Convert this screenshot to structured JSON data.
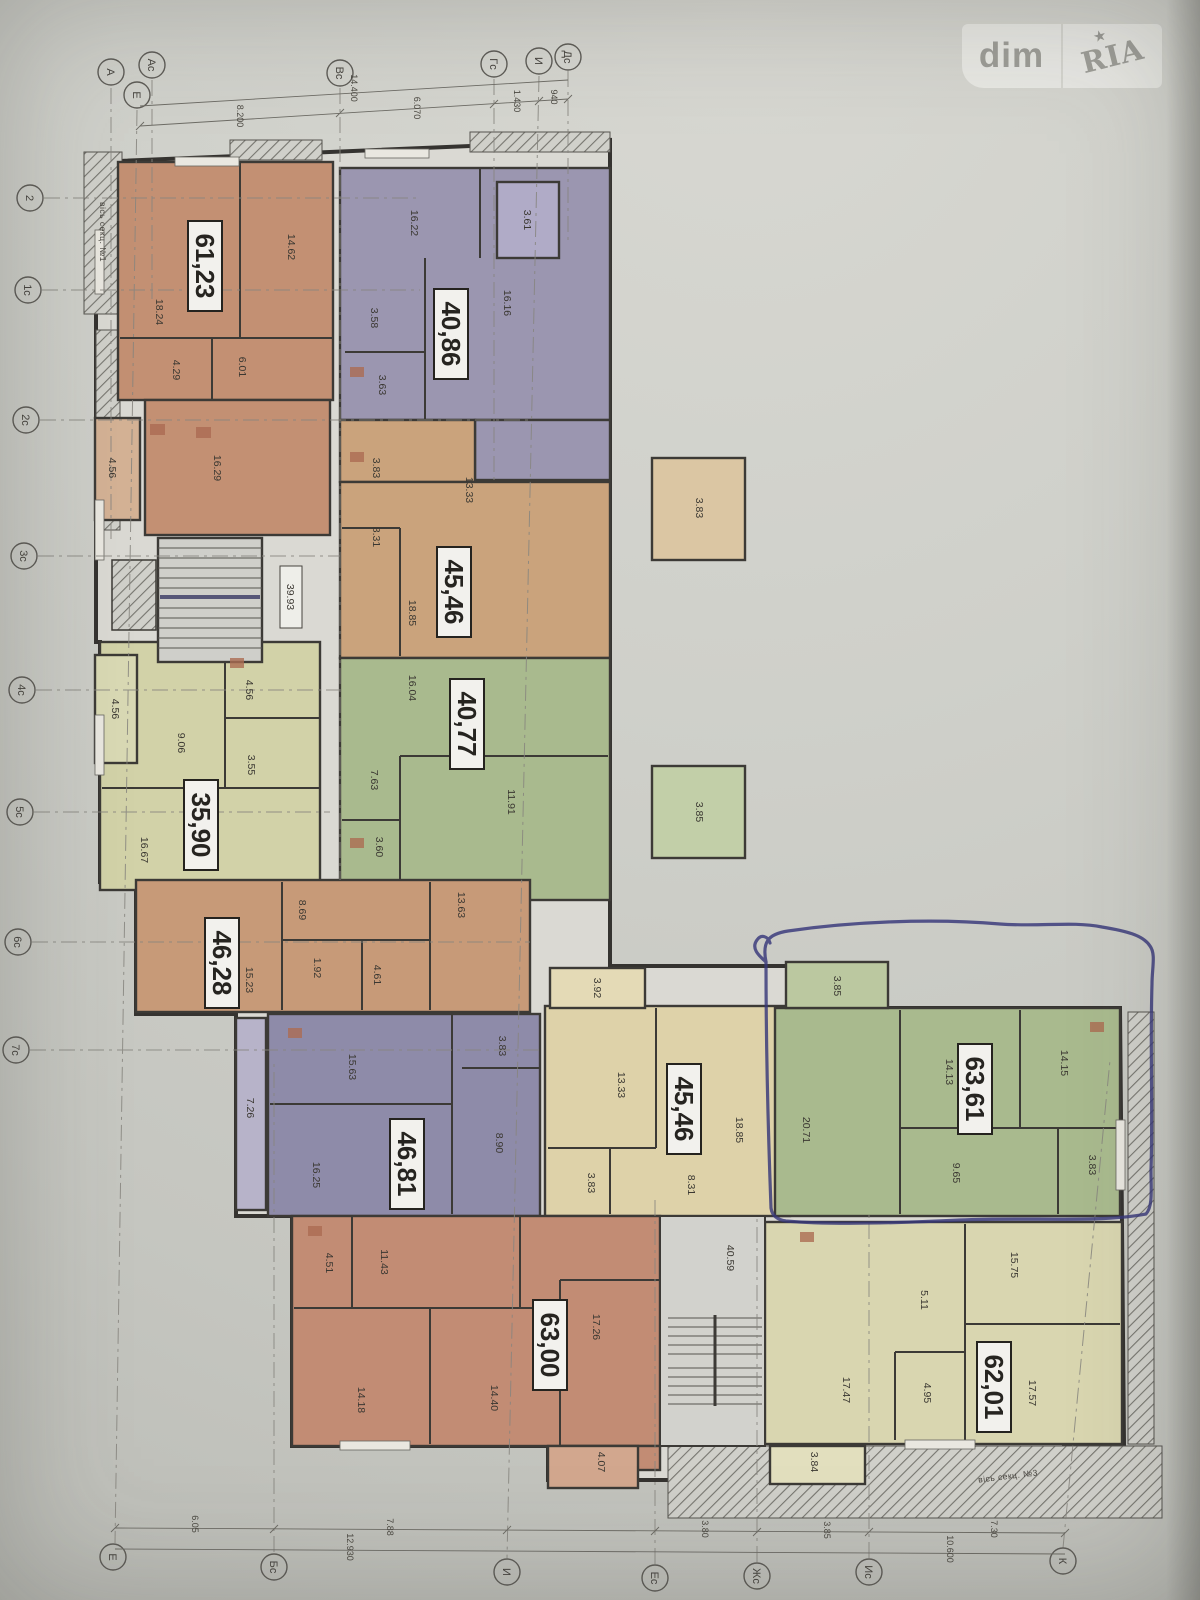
{
  "watermark": {
    "dim": "dim",
    "ria": "RIA",
    "star": "★"
  },
  "plan": {
    "section_notes": {
      "top_left": "вісь секц. №1",
      "bottom_right": "вісь секц. №3"
    },
    "stairwells": {
      "upper": "39.93",
      "lower": "40.59"
    },
    "axes": {
      "top": [
        "А",
        "Е",
        "Ас",
        "Вс",
        "Гс",
        "И",
        "Дс"
      ],
      "left": [
        "2",
        "1с",
        "2с",
        "3с",
        "4с",
        "5с",
        "6с",
        "7с"
      ],
      "bottom": [
        "Е",
        "Бс",
        "И",
        "Ес",
        "Жс",
        "Ис",
        "К"
      ]
    },
    "dimensions": {
      "top": [
        "14.400",
        "8.200",
        "6.070",
        "1.430",
        "940"
      ],
      "bottom": [
        "6.05",
        "7.88",
        "3.80",
        "3.85",
        "7.30",
        "12.930",
        "10.600"
      ]
    },
    "pen_color": "#35357f",
    "apartments": [
      {
        "name": "apartment-61-23",
        "total": "61,23",
        "color": "#c9906f",
        "balcony_color": "#d9b393",
        "rooms": [
          "14.62",
          "18.24",
          "4.29",
          "6.01",
          "16.29",
          "4.56"
        ]
      },
      {
        "name": "apartment-40-86",
        "total": "40,86",
        "color": "#9c96b4",
        "balcony_color": "#b2accb",
        "rooms": [
          "16.22",
          "16.16",
          "3.58",
          "3.63",
          "3.61"
        ]
      },
      {
        "name": "apartment-45-46-upper",
        "total": "45,46",
        "color": "#cfa478",
        "balcony_color": "#e0c8a1",
        "rooms": [
          "13.33",
          "8.31",
          "18.85",
          "3.83",
          "3.83"
        ]
      },
      {
        "name": "apartment-40-77",
        "total": "40,77",
        "color": "#a9bc8b",
        "balcony_color": "#c3d2a6",
        "rooms": [
          "16.04",
          "7.63",
          "11.91",
          "3.60",
          "3.85"
        ]
      },
      {
        "name": "apartment-35-90",
        "total": "35,90",
        "color": "#d5d5a6",
        "balcony_color": "#dcdcb2",
        "rooms": [
          "9.06",
          "3.55",
          "16.67",
          "4.56",
          "4.56"
        ]
      },
      {
        "name": "apartment-46-28",
        "total": "46,28",
        "color": "#cd9a74",
        "balcony_color": "#dcb693",
        "rooms": [
          "15.23",
          "13.63",
          "8.69",
          "1.92",
          "4.61"
        ]
      },
      {
        "name": "apartment-46-81",
        "total": "46,81",
        "color": "#8f8bad",
        "balcony_color": "#b9b4cd",
        "rooms": [
          "15.63",
          "16.25",
          "8.90",
          "3.83",
          "7.26"
        ]
      },
      {
        "name": "apartment-45-46-lower",
        "total": "45,46",
        "color": "#e2d5a7",
        "balcony_color": "#e8ddb4",
        "rooms": [
          "13.33",
          "8.31",
          "18.85",
          "3.83",
          "3.92"
        ]
      },
      {
        "name": "apartment-63-61",
        "total": "63,61",
        "color": "#a9bc8b",
        "balcony_color": "#bccb9e",
        "rooms": [
          "20.71",
          "14.13",
          "14.15",
          "9.65",
          "3.83",
          "3.85"
        ]
      },
      {
        "name": "apartment-63-00",
        "total": "63,00",
        "color": "#c88b71",
        "balcony_color": "#d8a88b",
        "rooms": [
          "4.51",
          "11.43",
          "14.18",
          "14.40",
          "17.26",
          "4.07"
        ]
      },
      {
        "name": "apartment-62-01",
        "total": "62,01",
        "color": "#dcd9ae",
        "balcony_color": "#e5e2bd",
        "rooms": [
          "15.75",
          "5.11",
          "17.47",
          "4.95",
          "17.57",
          "3.84"
        ]
      }
    ]
  }
}
